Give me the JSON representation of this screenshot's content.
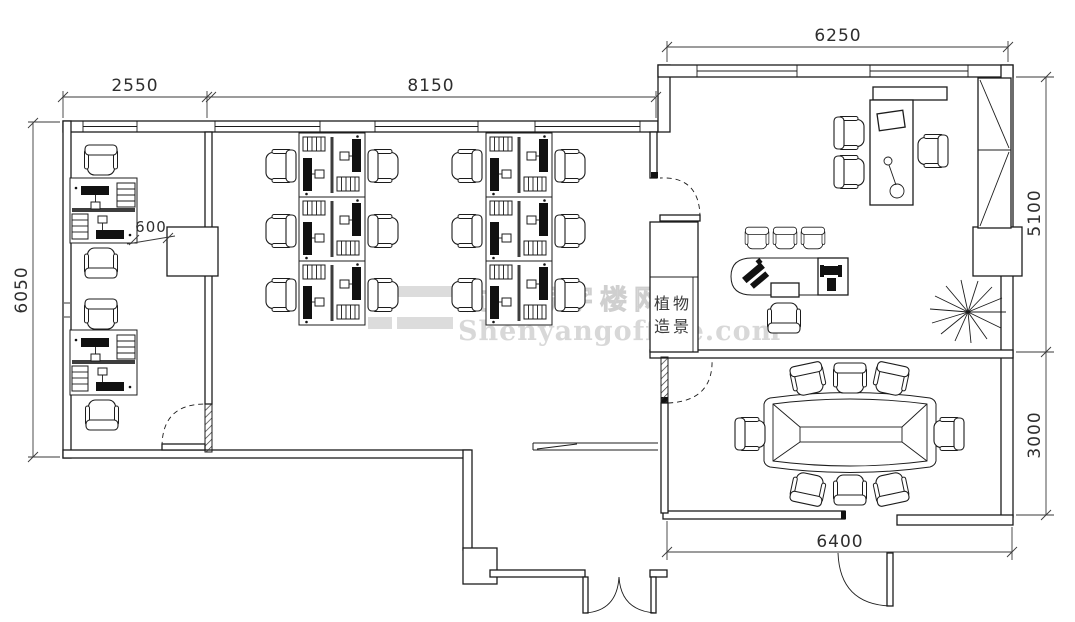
{
  "dimensions": {
    "top_left": "2550",
    "top_center": "8150",
    "top_right": "6250",
    "left": "6050",
    "right_upper": "5100",
    "right_lower": "3000",
    "bottom_right": "6400",
    "column_offset": "600"
  },
  "labels": {
    "plant_room_line1": "植物",
    "plant_room_line2": "造景"
  },
  "watermark": {
    "cn": "沈阳写字楼网",
    "en": "Shenyangoffice.com"
  },
  "colors": {
    "ink": "#1c1c1c",
    "watermark": "#d8d8d8"
  }
}
